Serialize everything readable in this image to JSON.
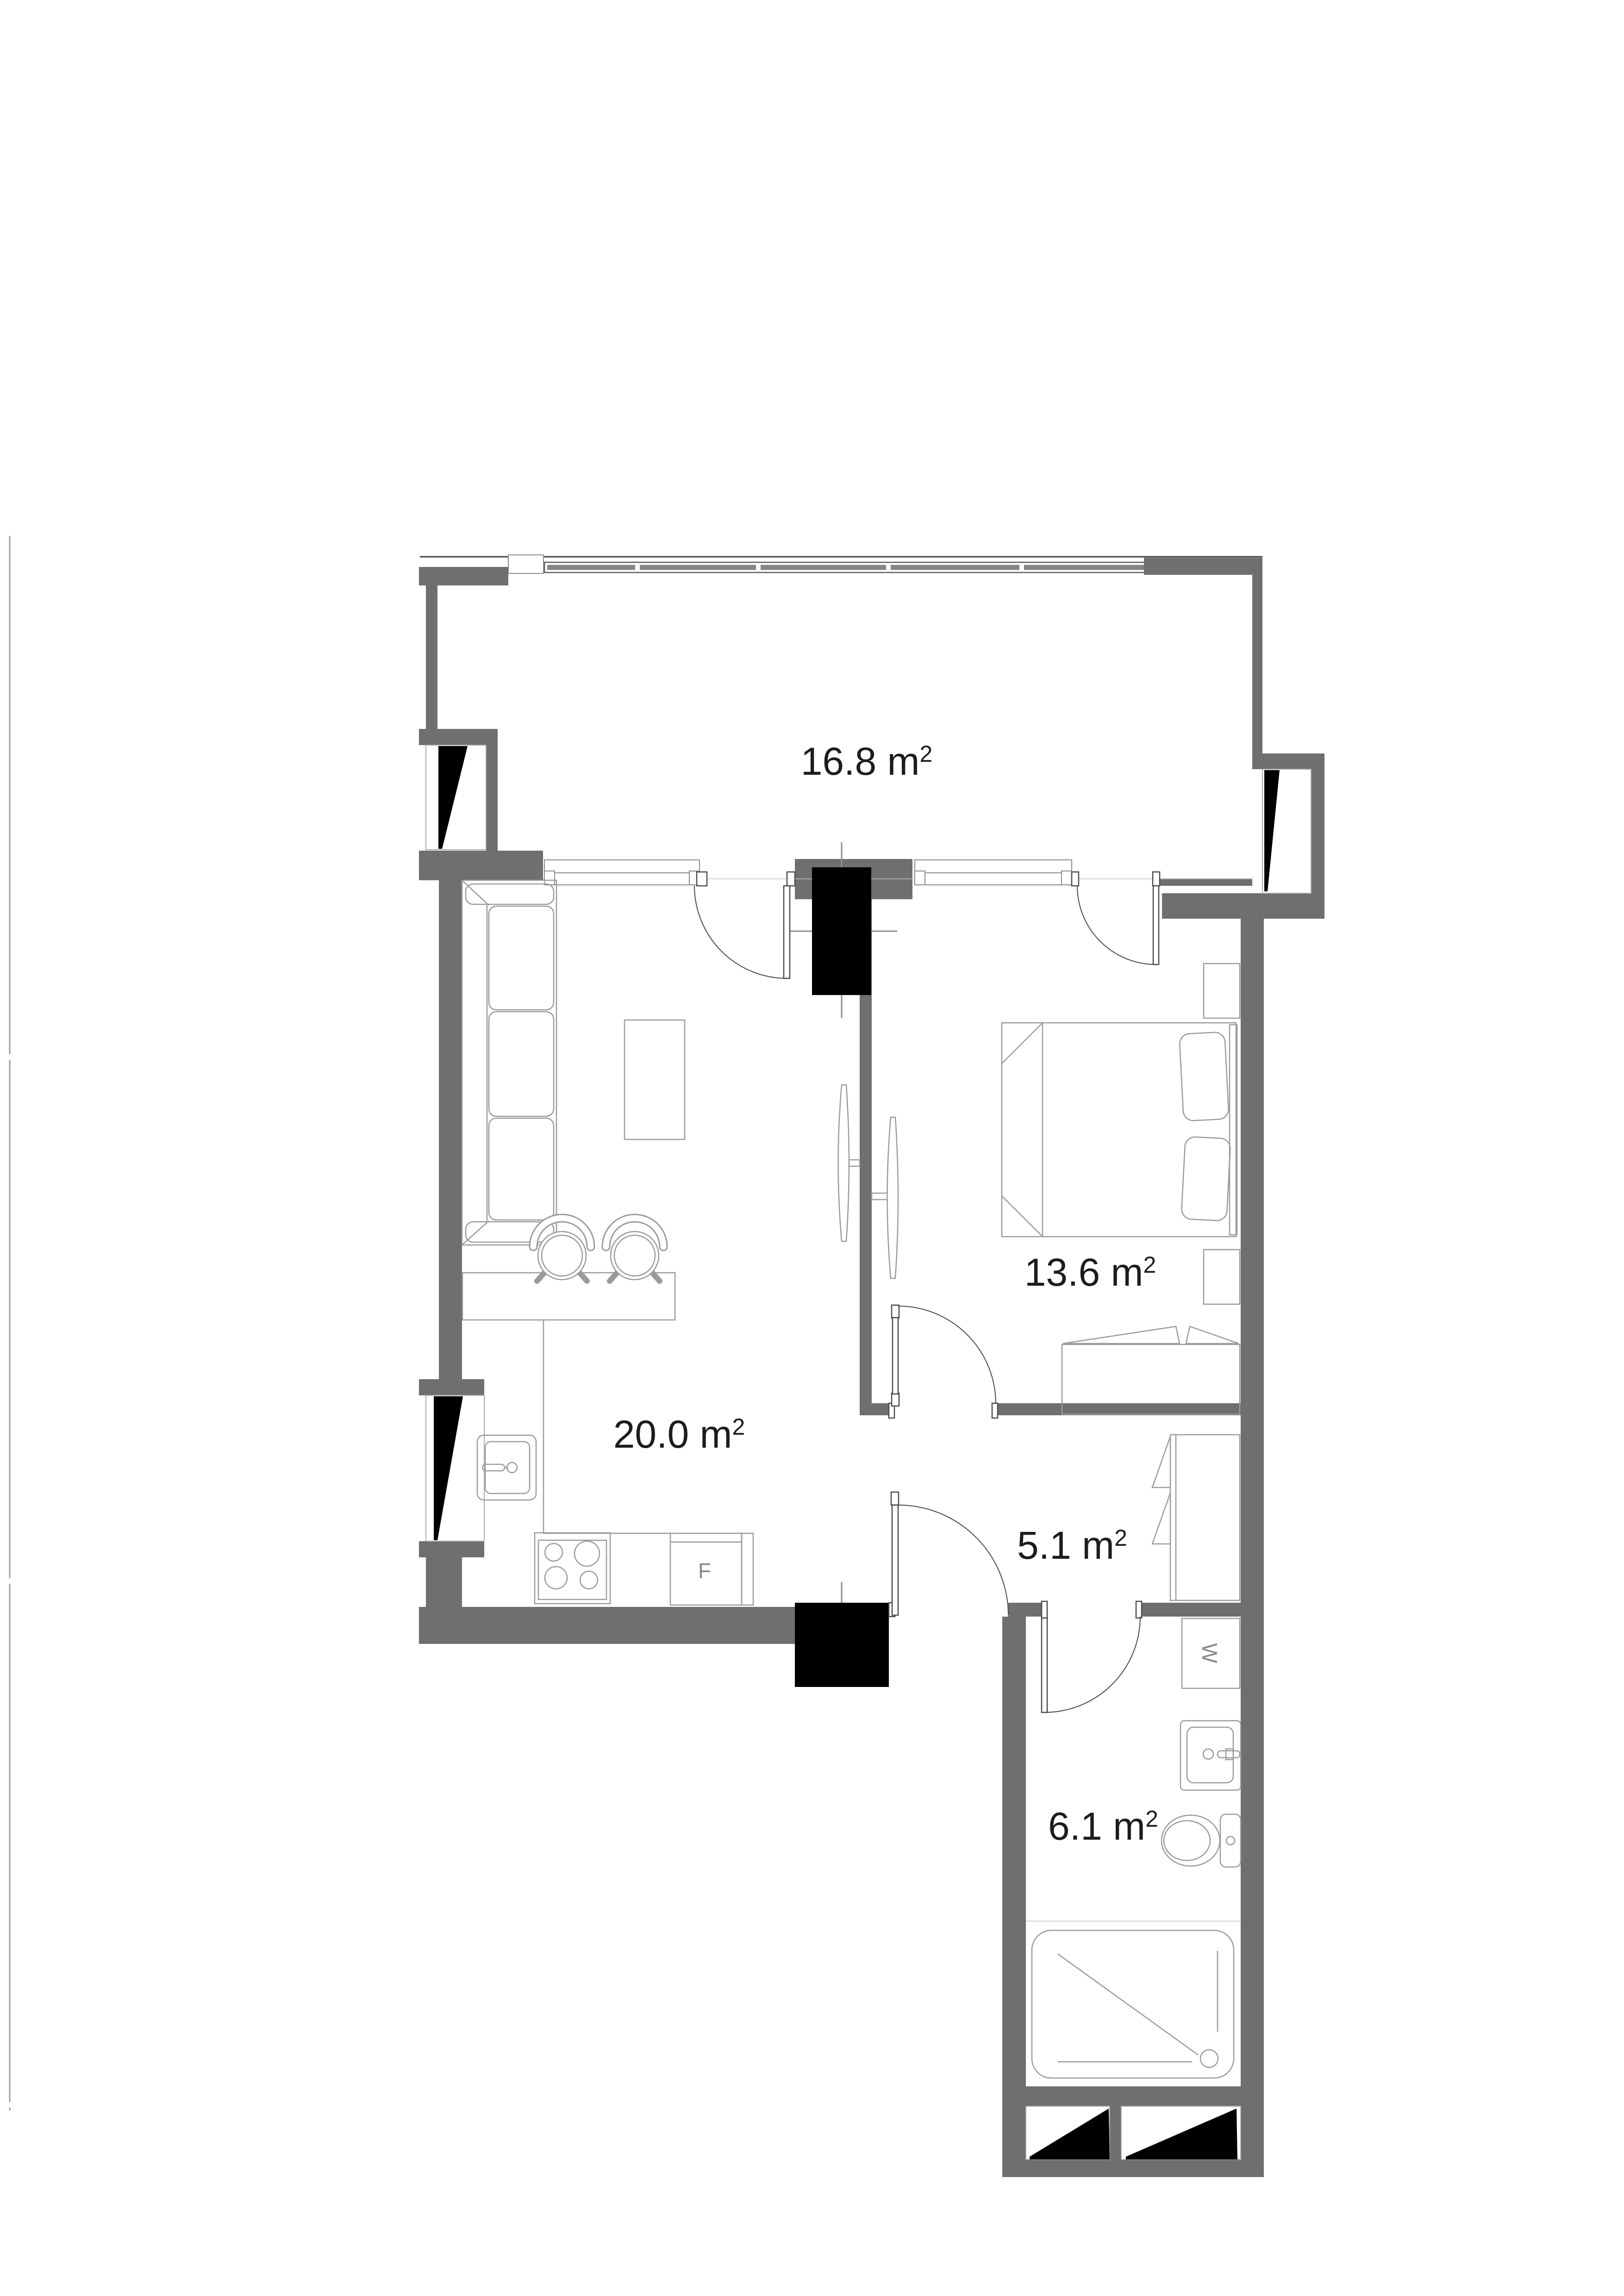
{
  "plan": {
    "sup": "2",
    "rooms": [
      {
        "id": "balcony",
        "label": "16.8 m"
      },
      {
        "id": "living-kitchen",
        "label": "20.0 m"
      },
      {
        "id": "bedroom",
        "label": "13.6 m"
      },
      {
        "id": "hallway",
        "label": "5.1 m"
      },
      {
        "id": "bathroom",
        "label": "6.1 m"
      }
    ],
    "appliances": {
      "fridge": "F",
      "washer": "W"
    },
    "colors": {
      "wall": "#6f6f6f",
      "marker": "#000000",
      "furniture_line": "#9b9b9b",
      "text": "#1c1c1c",
      "appliance_text": "#8a8a8a"
    }
  }
}
